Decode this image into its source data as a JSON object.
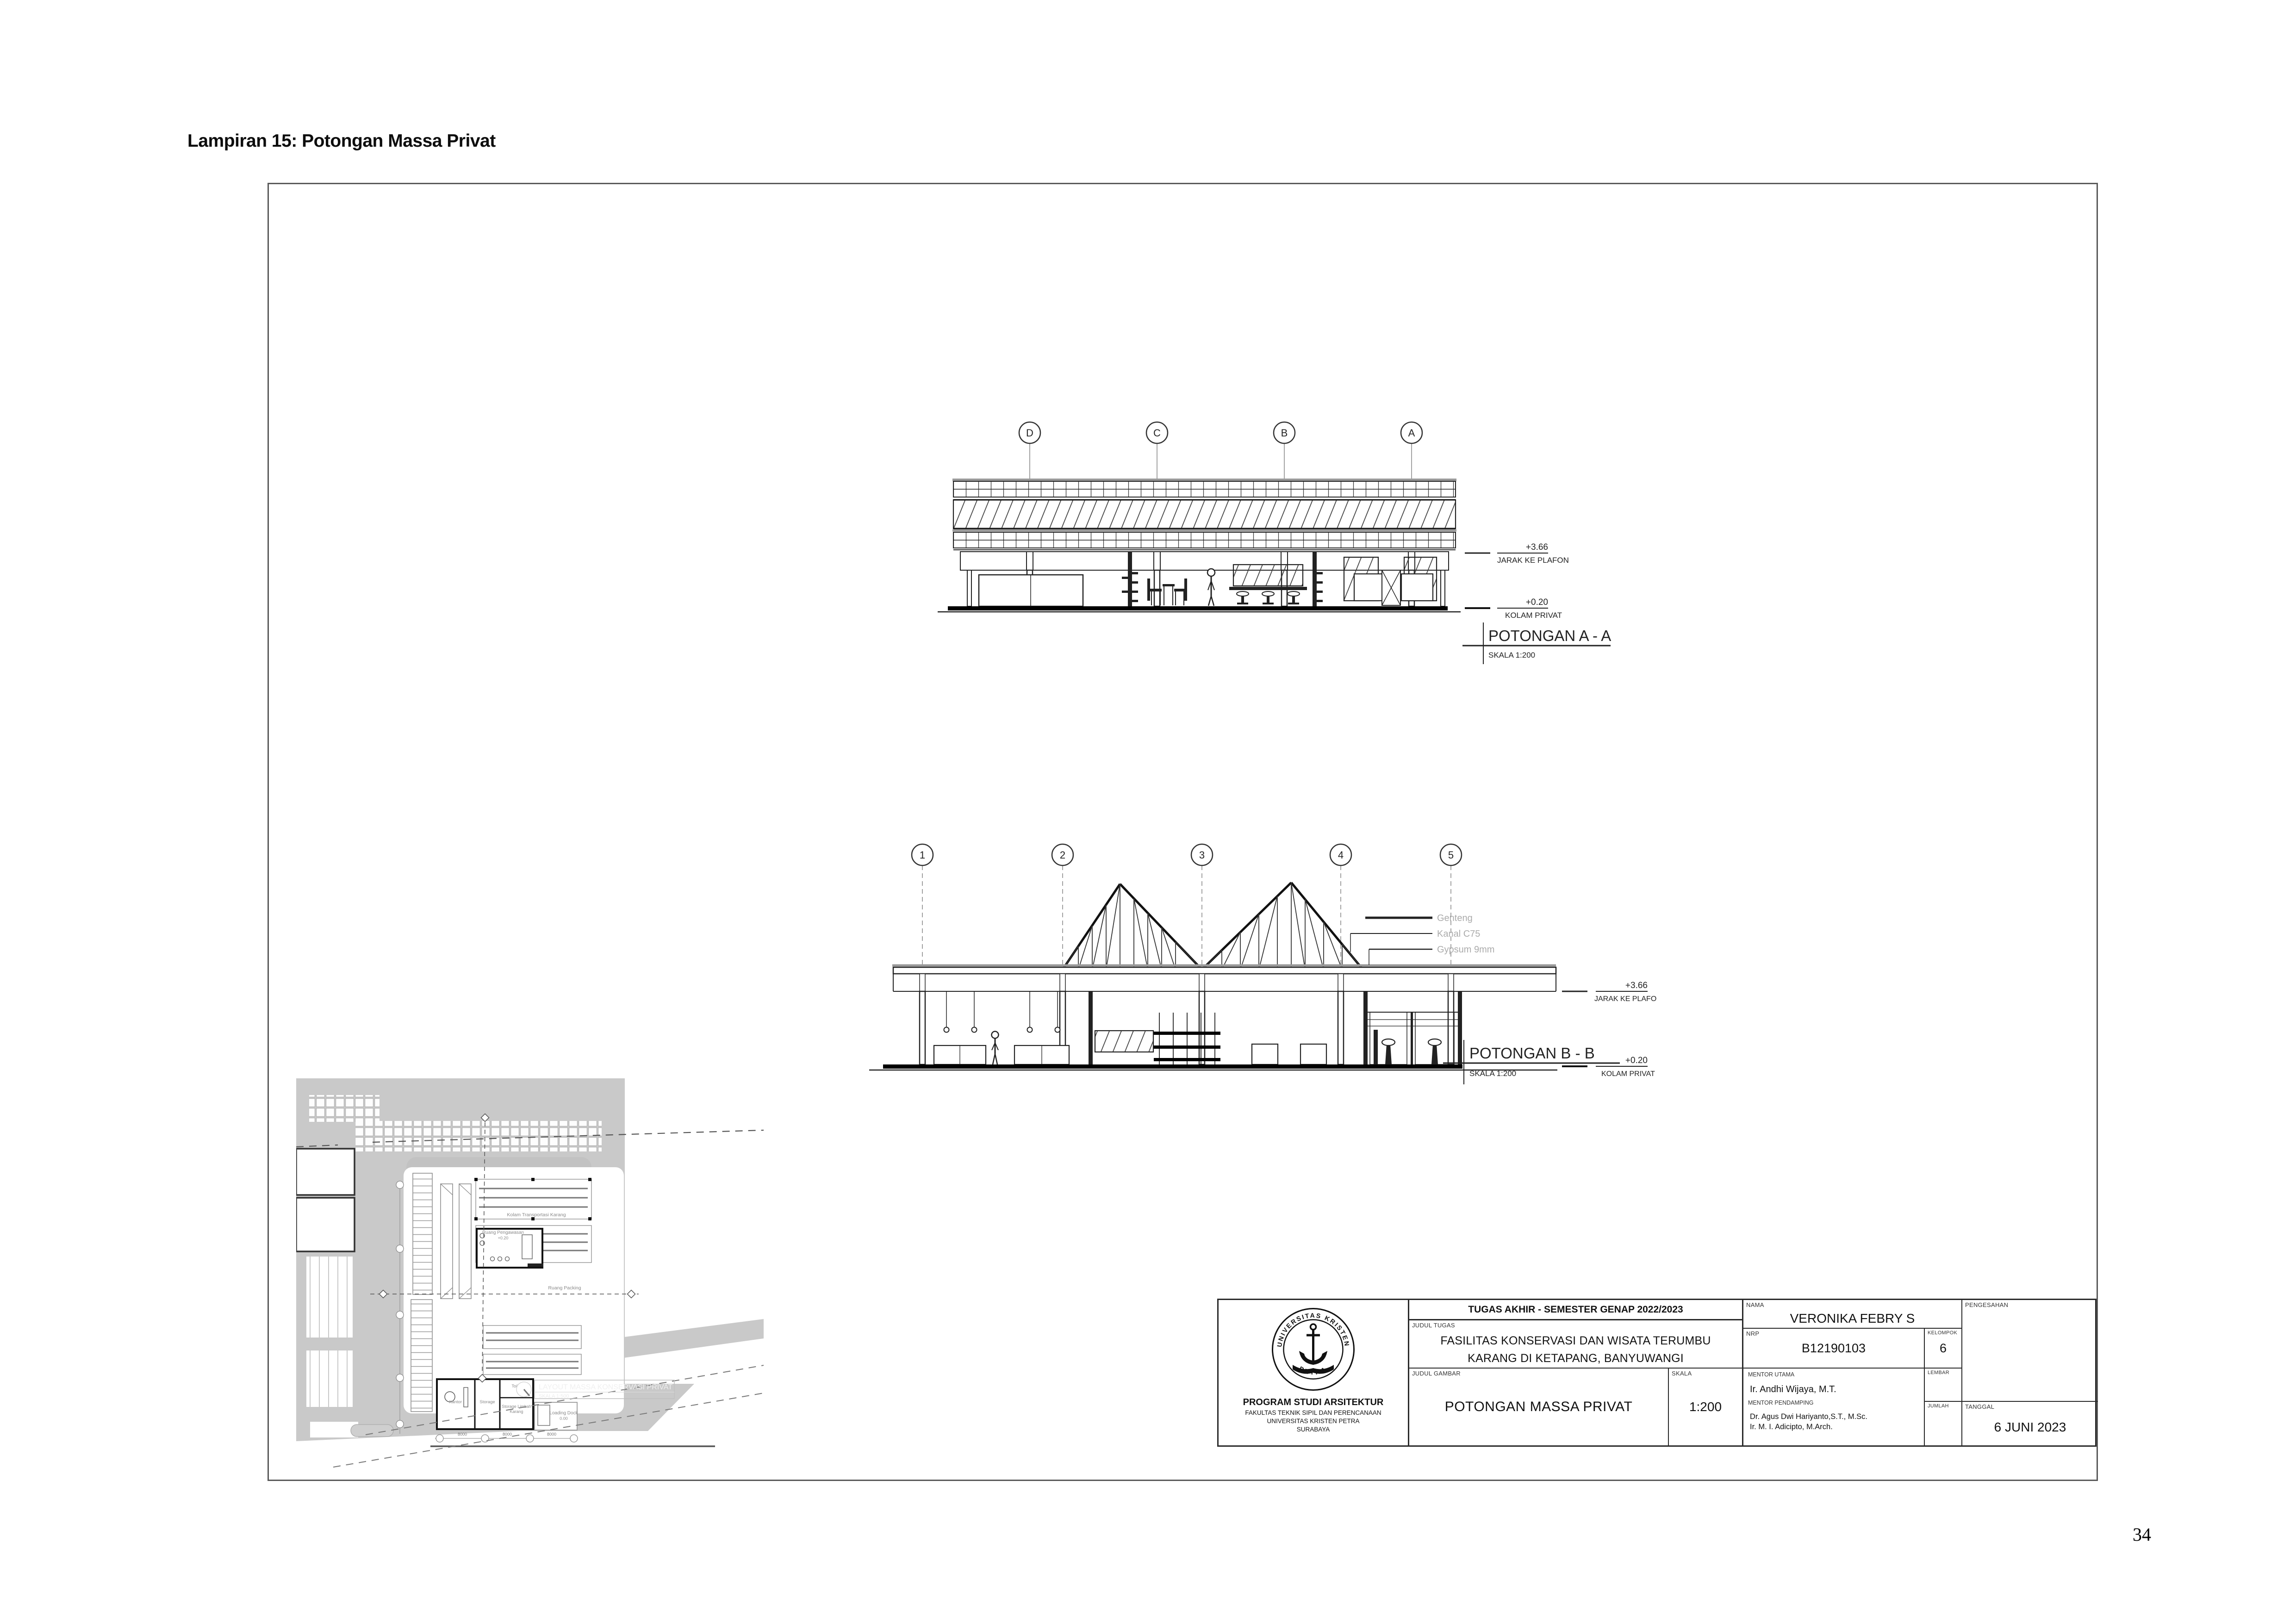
{
  "page": {
    "heading": "Lampiran 15: Potongan Massa Privat",
    "page_number": "34"
  },
  "section_aa": {
    "title": "POTONGAN A - A",
    "scale_label": "SKALA 1:200",
    "grid_labels": [
      "D",
      "C",
      "B",
      "A"
    ],
    "dims": {
      "plafon_value": "+3.66",
      "plafon_label": "JARAK KE PLAFON",
      "floor_value": "+0.20",
      "floor_label": "KOLAM PRIVAT"
    }
  },
  "section_bb": {
    "title": "POTONGAN B - B",
    "scale_label": "SKALA 1:200",
    "grid_labels": [
      "1",
      "2",
      "3",
      "4",
      "5"
    ],
    "dims": {
      "plafon_value": "+3.66",
      "plafon_label": "JARAK KE PLAFON",
      "floor_value": "+0.20",
      "floor_label": "KOLAM PRIVAT"
    },
    "callouts": [
      "Genteng",
      "Kanal C75",
      "Gypsum 9mm"
    ]
  },
  "siteplan": {
    "caption_title": "LAYOUT MASSA KONSERVASI PRIVAT",
    "caption_scale": "SKALA 1:500",
    "labels": {
      "kolam_transportasi": "Kolam Transportasi Karang",
      "ruang_pengawasan": "Ruang Pengawasan",
      "ruang_pengawasan_level": "+0.20",
      "ruang_packing": "Ruang Packing",
      "kantor": "Kantor",
      "storage": "Storage",
      "toilet": "Toilet",
      "storage_limbah_1": "Storage Limbah",
      "storage_limbah_2": "Karang",
      "loading_dock": "Loading Dock",
      "loading_dock_level": "0.00",
      "dim_8000": "8000"
    }
  },
  "titleblock": {
    "header": "TUGAS AKHIR - SEMESTER GENAP 2022/2023",
    "labels": {
      "judul_tugas": "JUDUL TUGAS",
      "judul_gambar": "JUDUL GAMBAR",
      "skala": "SKALA",
      "nama": "NAMA",
      "nrp": "NRP",
      "kelompok": "KELOMPOK",
      "mentor_utama": "MENTOR UTAMA",
      "mentor_pendamping": "MENTOR PENDAMPING",
      "lembar": "LEMBAR",
      "jumlah": "JUMLAH",
      "pengesahan": "PENGESAHAN",
      "tanggal": "TANGGAL"
    },
    "judul_tugas_line1": "FASILITAS KONSERVASI DAN WISATA TERUMBU",
    "judul_tugas_line2": "KARANG DI KETAPANG, BANYUWANGI",
    "judul_gambar": "POTONGAN MASSA PRIVAT",
    "skala": "1:200",
    "nama": "VERONIKA FEBRY S",
    "nrp": "B12190103",
    "kelompok": "6",
    "mentor_utama": "Ir. Andhi Wijaya, M.T.",
    "mentor_pendamping_1": "Dr. Agus Dwi Hariyanto,S.T., M.Sc.",
    "mentor_pendamping_2": "Ir. M. I. Adicipto, M.Arch.",
    "tanggal": "6 JUNI 2023",
    "institution": {
      "program": "PROGRAM STUDI ARSITEKTUR",
      "fakultas": "FAKULTAS TEKNIK SIPIL DAN PERENCANAAN",
      "universitas": "UNIVERSITAS KRISTEN PETRA",
      "kota": "SURABAYA"
    },
    "logo_ring_top": "UNIVERSITAS KRISTEN",
    "logo_ring_bottom": "PETRA"
  }
}
